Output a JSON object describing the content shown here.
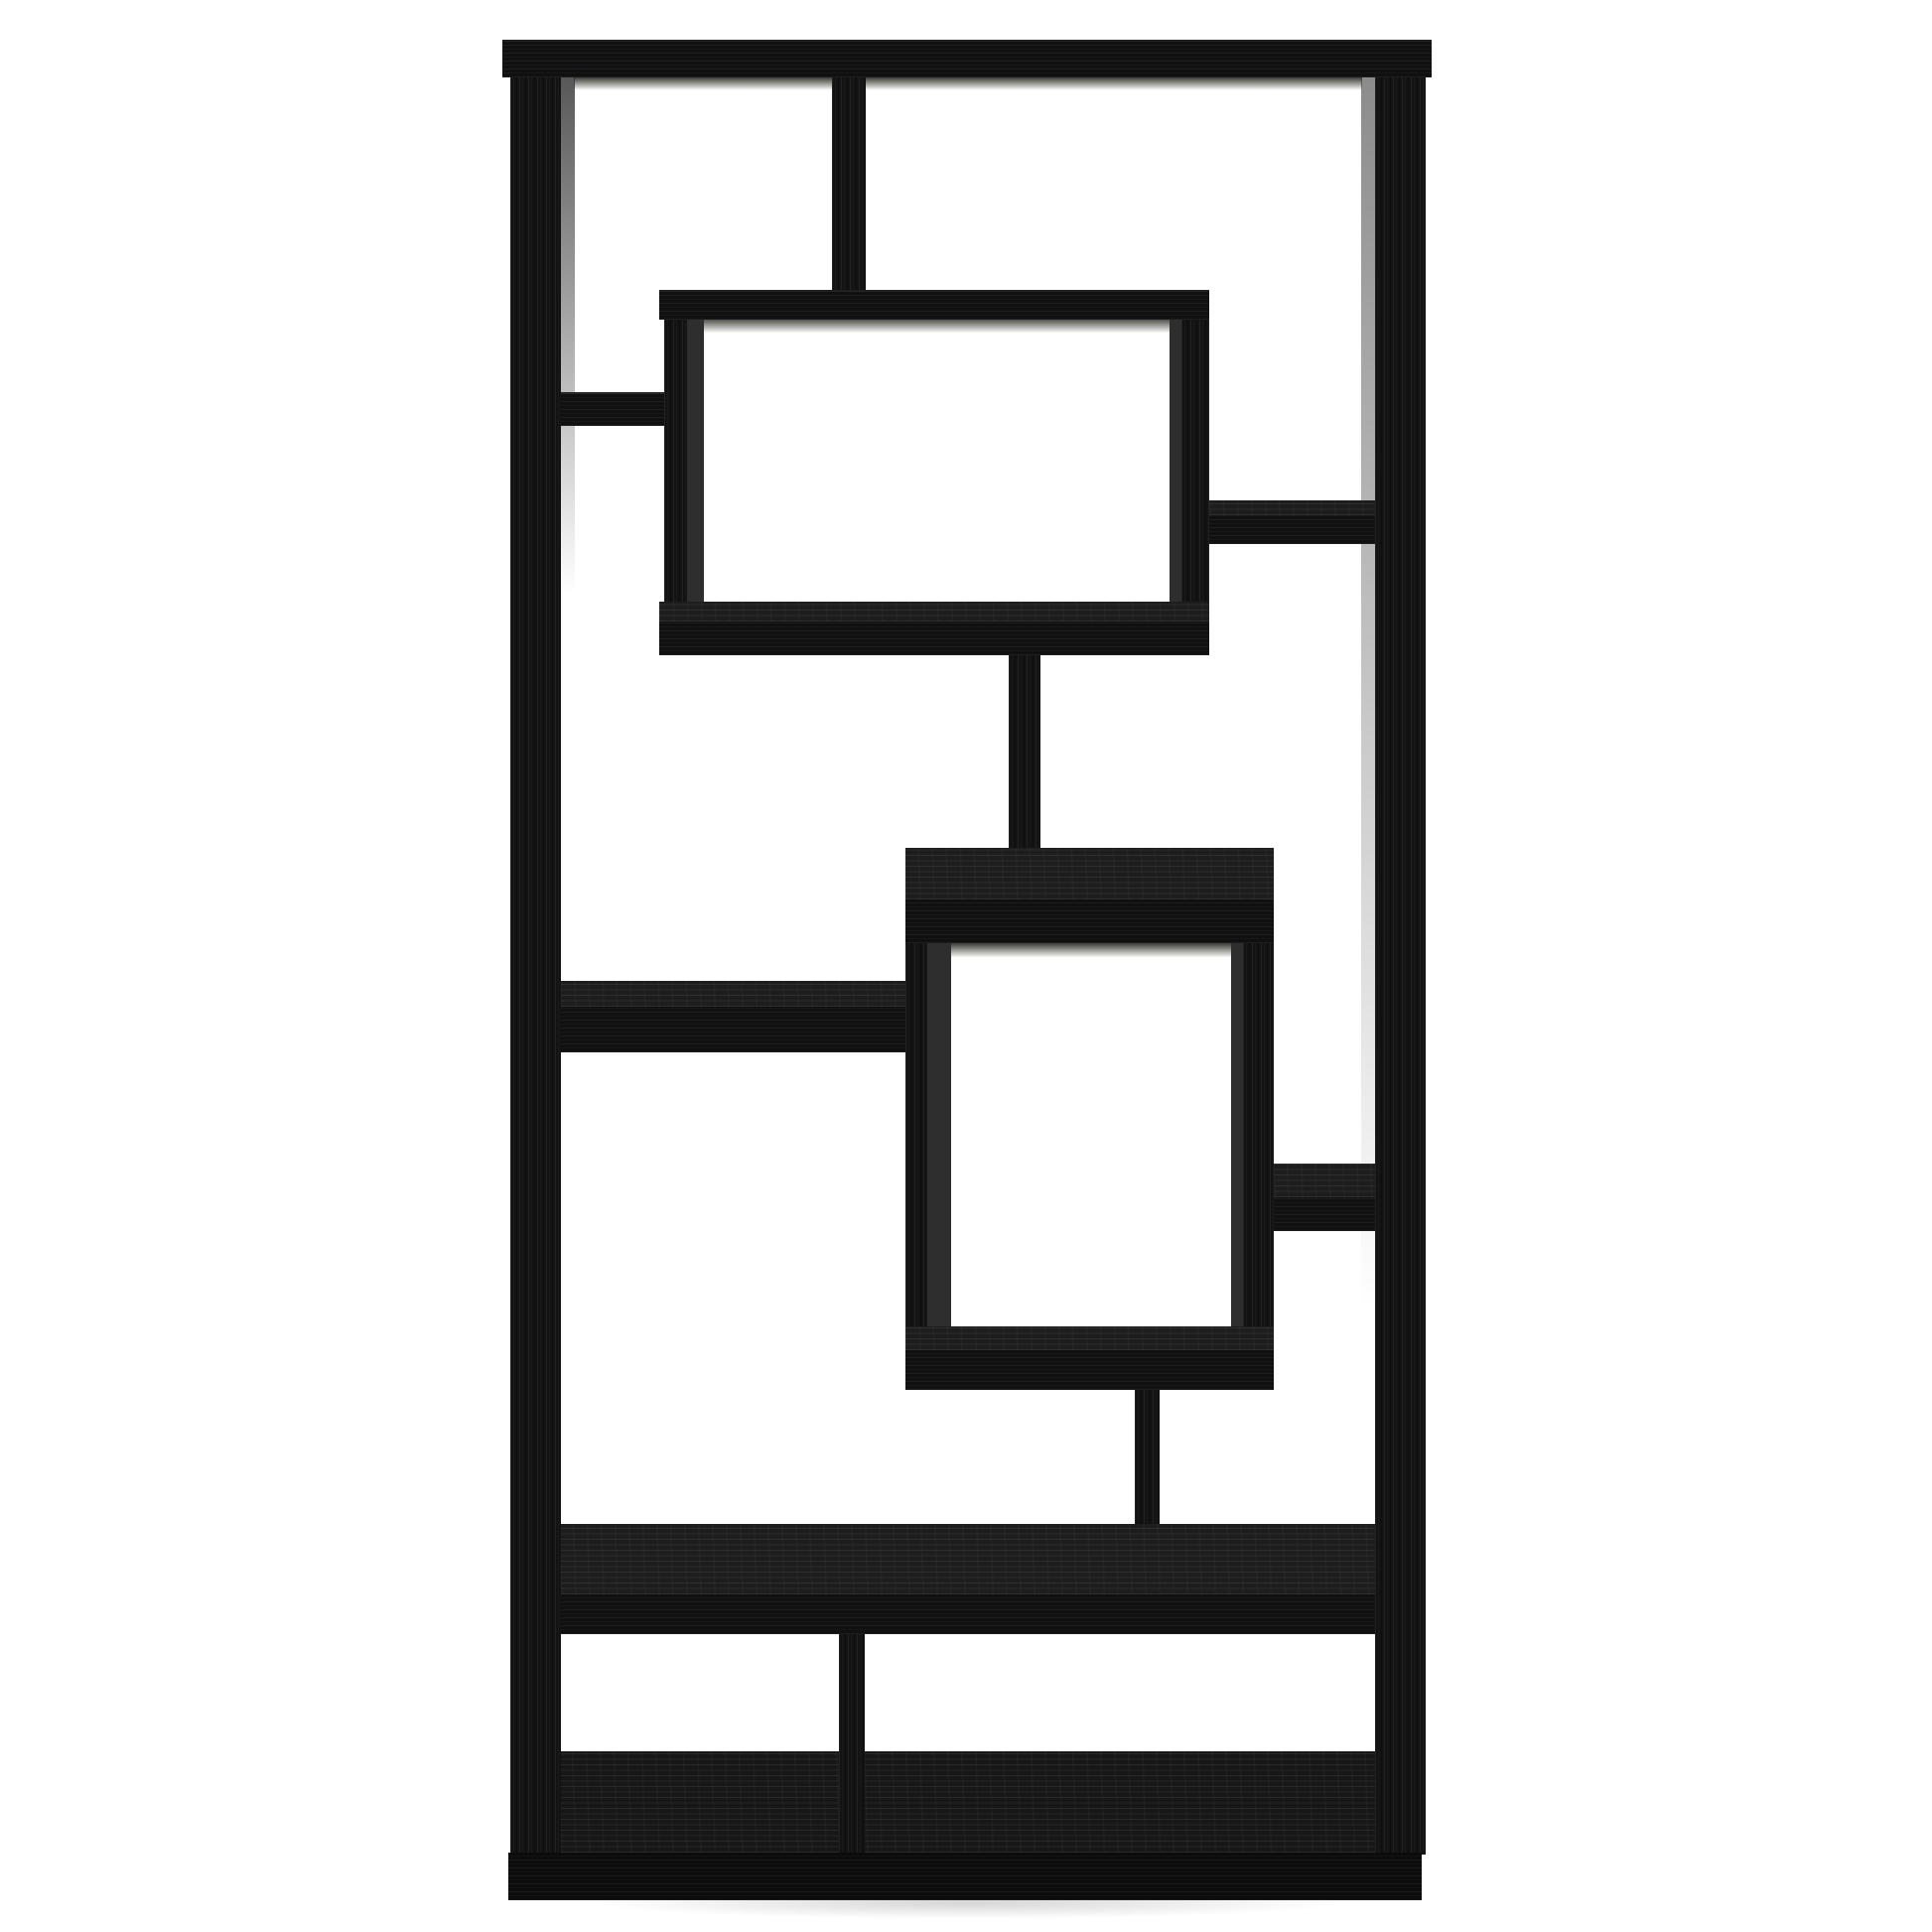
{
  "subject": {
    "kind": "product-photo",
    "item": "geometric-bookcase",
    "finish": "black-oak-woodgrain",
    "backdrop": "plain-white"
  },
  "colors": {
    "background": "#ffffff",
    "wood_face": "#131313",
    "wood_face_h": "#101010",
    "wood_top": "#1d1d1d",
    "wood_top_floor": "#171717",
    "edge_shadow": "#2e2e2e",
    "inner_shadow": "#3c3c35",
    "plinth": "#0c0c0c",
    "ground_shadow": "rgba(0,0,0,0.16)"
  }
}
